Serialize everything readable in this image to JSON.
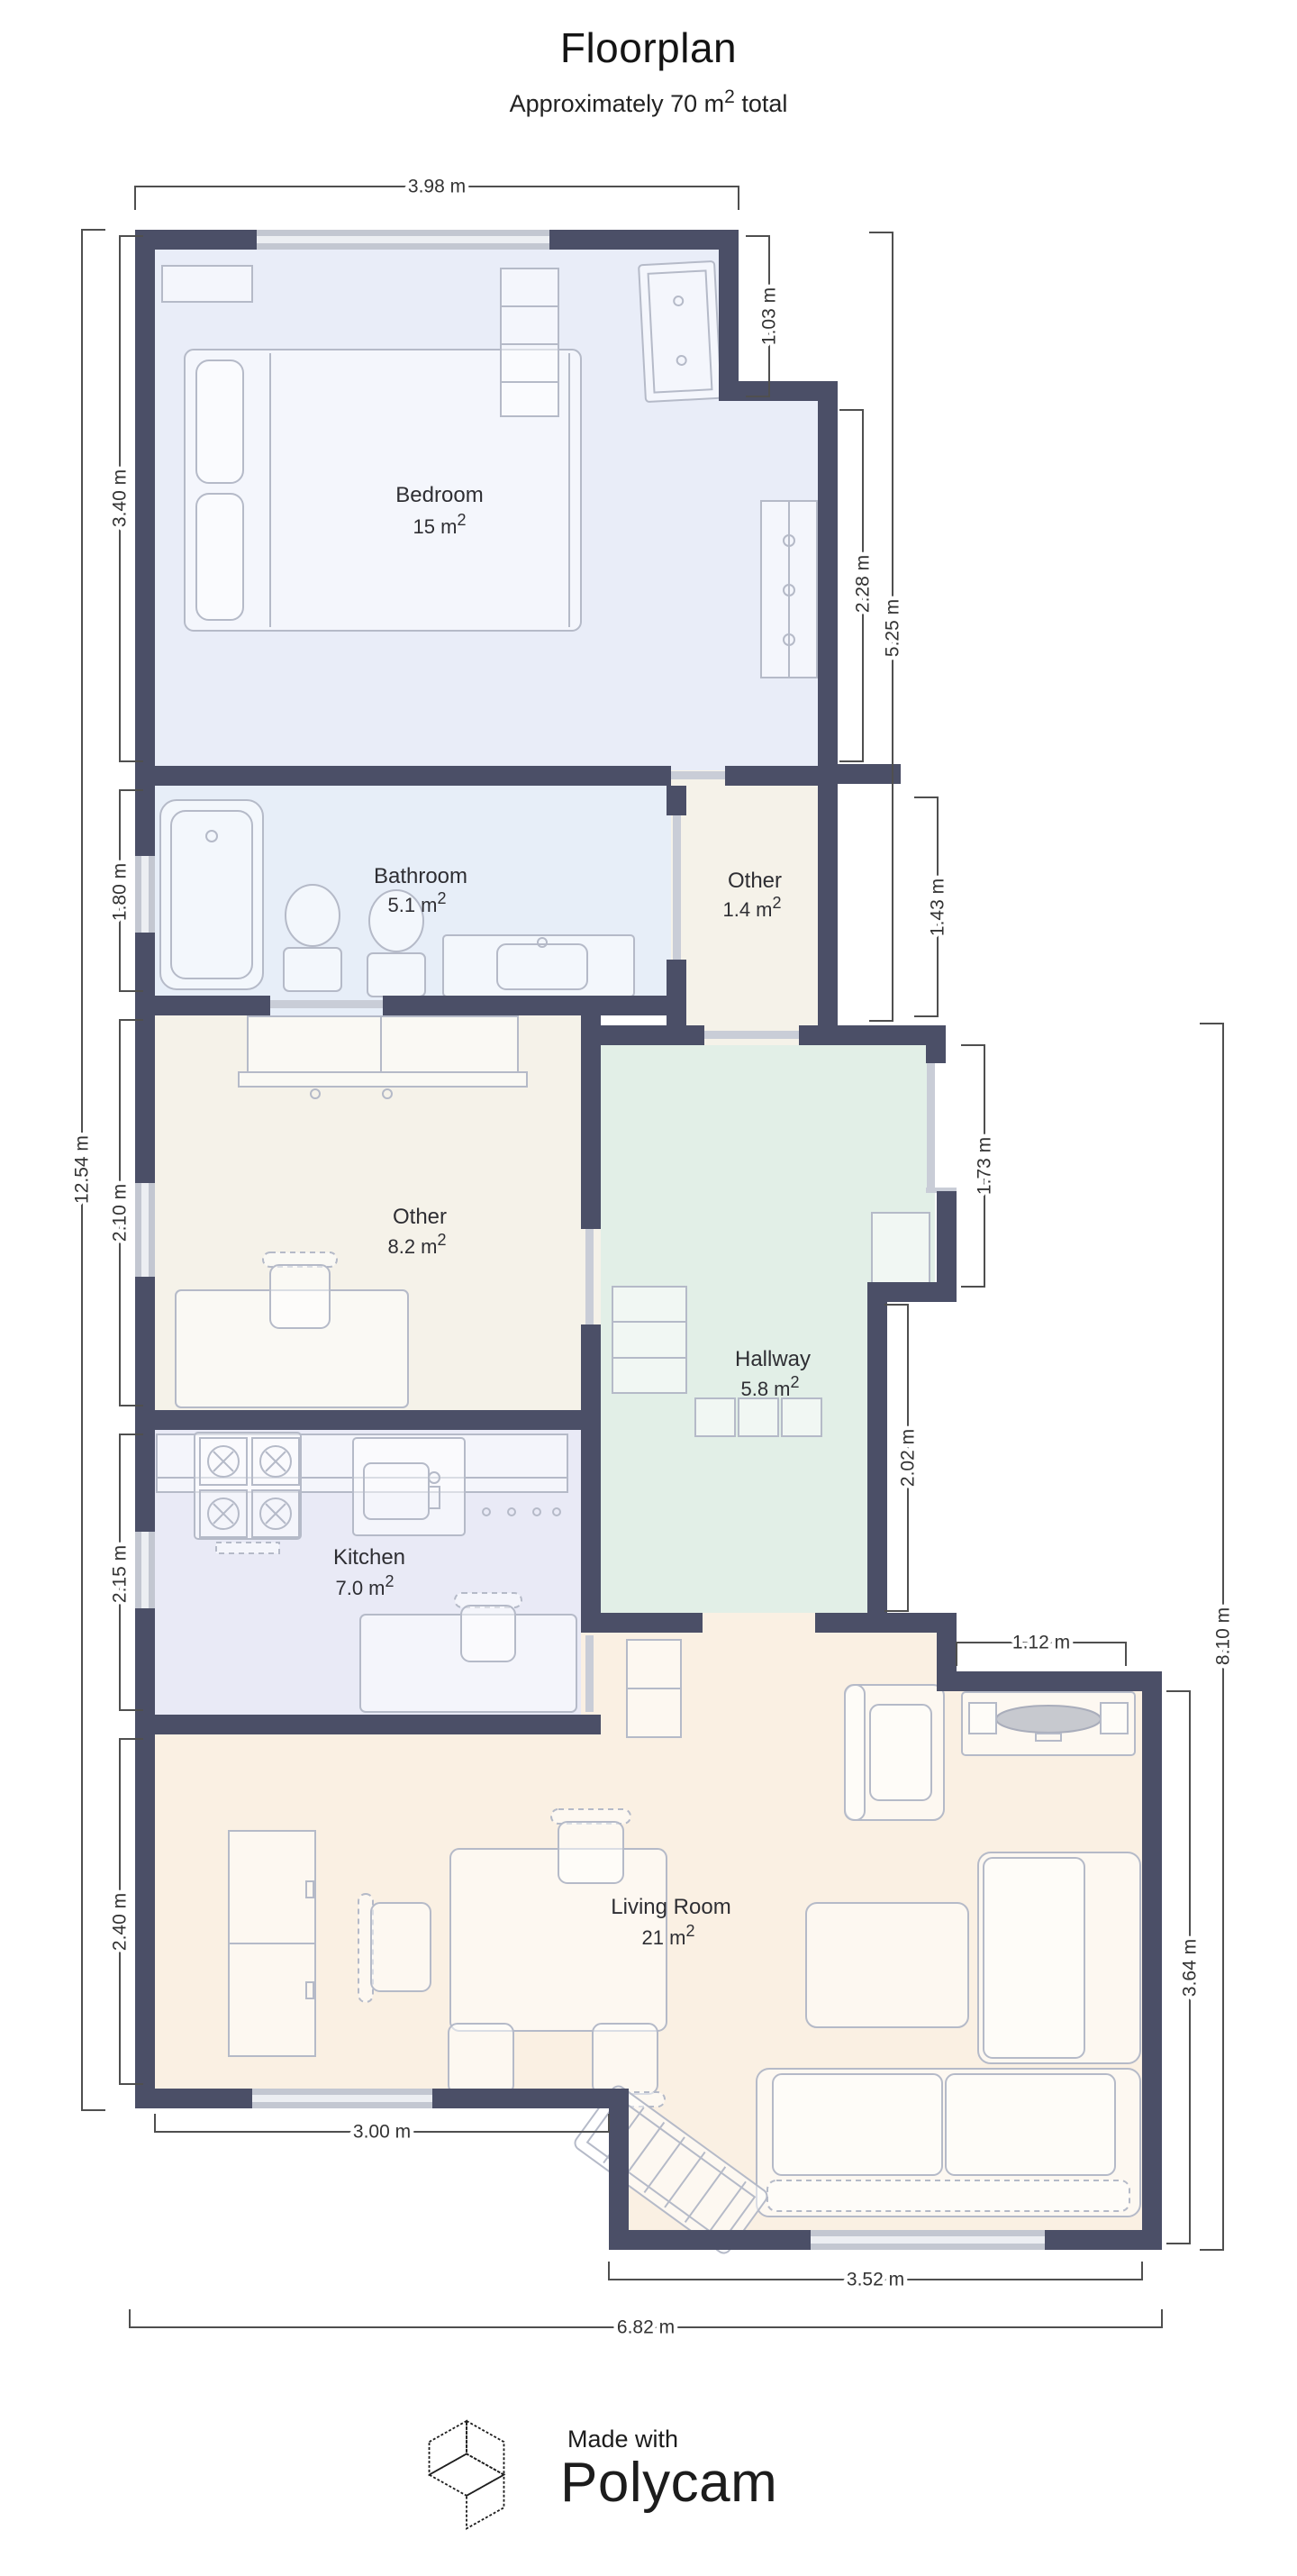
{
  "header": {
    "title": "Floorplan",
    "subtitle_pre": "Approximately 70 m",
    "subtitle_sup": "2",
    "subtitle_post": " total"
  },
  "rooms": {
    "bedroom": {
      "name": "Bedroom",
      "area": "15 m",
      "sup": "2"
    },
    "bathroom": {
      "name": "Bathroom",
      "area": "5.1 m",
      "sup": "2"
    },
    "other_small": {
      "name": "Other",
      "area": "1.4 m",
      "sup": "2"
    },
    "other_large": {
      "name": "Other",
      "area": "8.2 m",
      "sup": "2"
    },
    "hallway": {
      "name": "Hallway",
      "area": "5.8 m",
      "sup": "2"
    },
    "kitchen": {
      "name": "Kitchen",
      "area": "7.0 m",
      "sup": "2"
    },
    "living": {
      "name": "Living Room",
      "area": "21 m",
      "sup": "2"
    }
  },
  "dims": {
    "top_width": "3.98 m",
    "bedroom_height": "3.40 m",
    "notch_height": "1.03 m",
    "wardrobe_nook": "2.28 m",
    "right_upper": "5.25 m",
    "bathroom_height": "1.80 m",
    "entry_recess": "1.43 m",
    "total_left": "12.54 m",
    "other_height": "2.10 m",
    "entry_door": "1.73 m",
    "kitchen_height": "2.15 m",
    "hall_lower": "2.02 m",
    "right_total": "8.10 m",
    "living_step": "1.12 m",
    "living_left_height": "2.40 m",
    "living_right_height": "3.64 m",
    "living_left_width": "3.00 m",
    "living_right_width": "3.52 m",
    "bottom_total": "6.82 m"
  },
  "footer": {
    "made_with": "Made with",
    "brand": "Polycam"
  },
  "colors": {
    "wall": "#4b4f67",
    "bedroom_fill": "#e9edf8",
    "bathroom_fill": "#e7eef8",
    "other_fill": "#f5f2e9",
    "hallway_fill": "#e2efe7",
    "kitchen_fill": "#e9eaf6",
    "living_fill": "#faf0e3",
    "window": "#c3c7d1",
    "dimension_line": "#4f4f4f"
  }
}
